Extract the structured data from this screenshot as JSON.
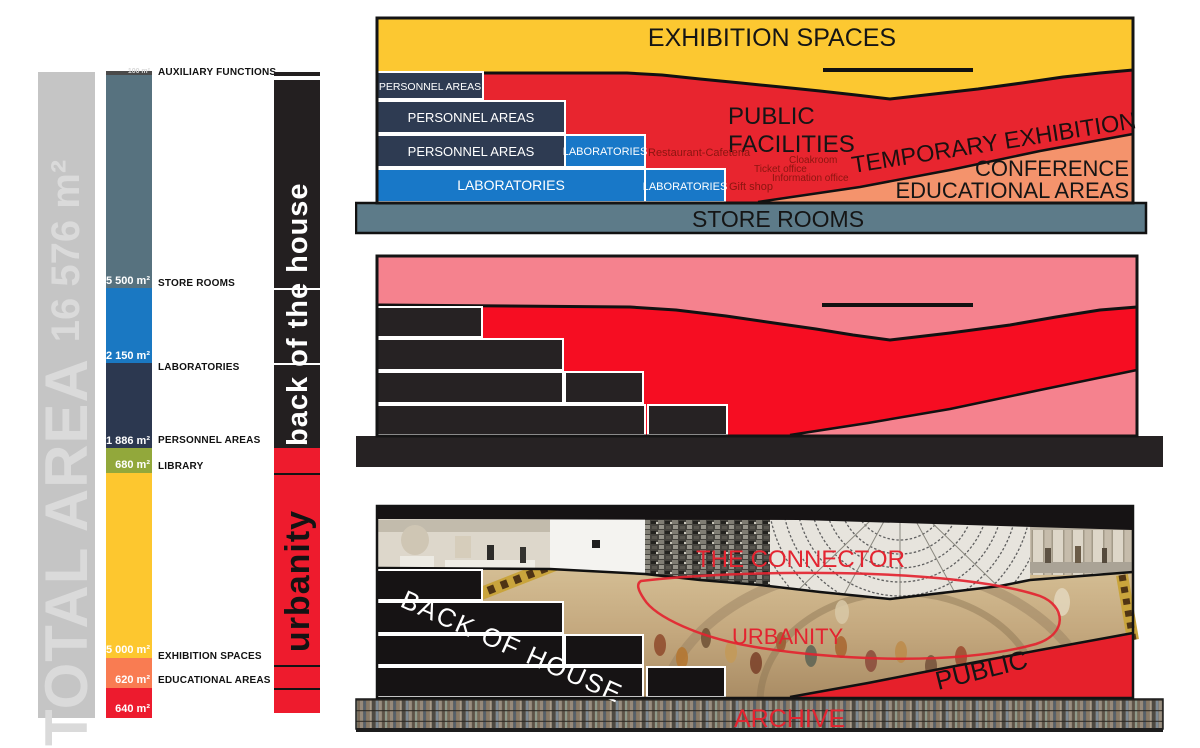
{
  "left_panel": {
    "total_bar": {
      "label": "TOTAL AREA",
      "value": "16 576 m²"
    },
    "area_chart": {
      "segments": [
        {
          "label": "AUXILIARY FUNCTIONS",
          "value": "100 m²",
          "color": "#4a4a4a"
        },
        {
          "label": "STORE ROOMS",
          "value": "5 500 m²",
          "color": "#57727f"
        },
        {
          "label": "LABORATORIES",
          "value": "2 150 m²",
          "color": "#1a78c2"
        },
        {
          "label": "PERSONNEL AREAS",
          "value": "1 886 m²",
          "color": "#2c3850"
        },
        {
          "label": "LIBRARY",
          "value": "680 m²",
          "color": "#92a83b"
        },
        {
          "label": "EXHIBITION SPACES",
          "value": "5 000 m²",
          "color": "#fdc72f"
        },
        {
          "label": "EDUCATIONAL AREAS",
          "value": "620 m²",
          "color": "#f97c52"
        },
        {
          "label": "",
          "value": "640 m²",
          "color": "#ed1b2e"
        }
      ]
    },
    "category_bar": {
      "back_label": "back of the house",
      "public_label": "urbanity",
      "back_color": "#231f20",
      "public_color": "#ee1b2d"
    }
  },
  "section_functional": {
    "exhibition_label": "EXHIBITION SPACES",
    "personnel_row1": "PERSONNEL AREAS",
    "personnel_row2": "PERSONNEL AREAS",
    "personnel_row3": "PERSONNEL AREAS",
    "lab_row1": "LABORATORIES",
    "lab_row2": "LABORATORIES",
    "lab_row3": "LABORATORIES",
    "public_line1": "PUBLIC",
    "public_line2": "FACILITIES",
    "restaurant": "Restaurant-Cafeteria",
    "cloakroom": "Cloakroom",
    "ticket_office": "Ticket office",
    "information_office": "Information office",
    "gift_shop": "Gift shop",
    "temporary_exhibition": "TEMPORARY EXHIBITION",
    "conference": "CONFERENCE",
    "educational_areas": "EDUCATIONAL AREAS",
    "store_rooms": "STORE ROOMS",
    "colors": {
      "yellow": "#fcc831",
      "red": "#e8252f",
      "navy": "#2e3b52",
      "blue": "#1878c8",
      "slate": "#5d7b89",
      "orange": "#f4936c"
    }
  },
  "section_massing": {
    "colors": {
      "pink": "#f5828e",
      "red": "#f60d22",
      "black": "#262223"
    }
  },
  "section_collage": {
    "connector": "THE CONNECTOR",
    "back_of_house": "BACK OF HOUSE",
    "urbanity": "URBANITY",
    "public": "PUBLIC",
    "archive": "ARCHIVE",
    "annotation_color": "#e32430"
  }
}
